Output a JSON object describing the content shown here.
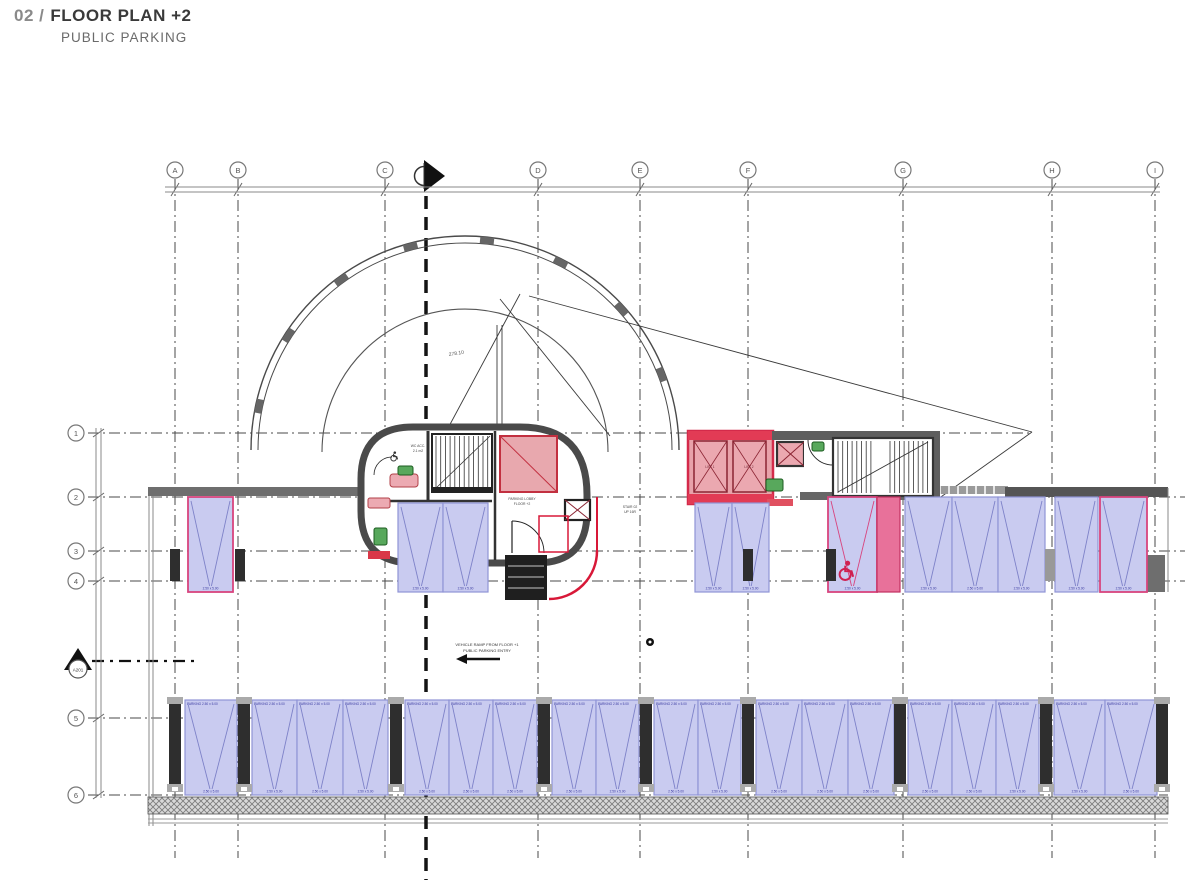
{
  "title": {
    "number": "02 /",
    "name": "FLOOR PLAN +2",
    "subtitle": "PUBLIC PARKING"
  },
  "colors": {
    "space_fill": "#c9cbf0",
    "space_border": "#9094d6",
    "space_line": "#7e82c8",
    "accent_pink_border": "#d8447e",
    "stripe_fill": "#e8719a",
    "stripe_border": "#c23060",
    "elevator_fill": "#e8a2aa",
    "elevator_frame": "#d42a4a",
    "elevator_inner": "#8b2433",
    "red_line": "#d81838",
    "wall_gray": "#6e6e6e",
    "wall_dark": "#3a3a3a",
    "grid_line": "#4a4a4a",
    "green_fixture": "#58a85c",
    "label_blue": "#3a3aa0"
  },
  "grid": {
    "columns": [
      {
        "label": "A",
        "x": 175
      },
      {
        "label": "B",
        "x": 238
      },
      {
        "label": "C",
        "x": 385
      },
      {
        "label": "D",
        "x": 538
      },
      {
        "label": "E",
        "x": 640
      },
      {
        "label": "F",
        "x": 748
      },
      {
        "label": "G",
        "x": 903
      },
      {
        "label": "H",
        "x": 1052
      },
      {
        "label": "I",
        "x": 1155
      }
    ],
    "rows": [
      {
        "label": "1",
        "y": 433,
        "x2": 1032
      },
      {
        "label": "2",
        "y": 497,
        "x2": 1185
      },
      {
        "label": "3",
        "y": 551,
        "x2": 1185
      },
      {
        "label": "4",
        "y": 581,
        "x2": 1185
      },
      {
        "label": "5",
        "y": 718,
        "x2": 1168
      },
      {
        "label": "6",
        "y": 795,
        "x2": 1168
      }
    ],
    "section_row_y": 661,
    "section_tag": "A201"
  },
  "arc": {
    "ticks_deg": [
      168,
      147,
      126,
      105,
      84,
      63,
      42,
      21
    ],
    "dim_label": "278.10"
  },
  "parking": {
    "space_label": "2.50 x 5.00",
    "space_label_top": "PARKING",
    "upper_row": [
      {
        "x": 188,
        "w": 45,
        "y": 497,
        "h": 95,
        "variant": "pink"
      },
      {
        "x": 398,
        "w": 45,
        "y": 503,
        "h": 89,
        "variant": "std"
      },
      {
        "x": 443,
        "w": 45,
        "y": 503,
        "h": 89,
        "variant": "std"
      },
      {
        "x": 695,
        "w": 37,
        "y": 503,
        "h": 89,
        "variant": "std"
      },
      {
        "x": 732,
        "w": 37,
        "y": 503,
        "h": 89,
        "variant": "std"
      },
      {
        "x": 828,
        "w": 49,
        "y": 497,
        "h": 95,
        "variant": "handicap"
      },
      {
        "x": 877,
        "w": 23,
        "y": 497,
        "h": 95,
        "variant": "stripe"
      },
      {
        "x": 905,
        "w": 47,
        "y": 497,
        "h": 95,
        "variant": "std"
      },
      {
        "x": 952,
        "w": 46,
        "y": 497,
        "h": 95,
        "variant": "std"
      },
      {
        "x": 998,
        "w": 47,
        "y": 497,
        "h": 95,
        "variant": "std"
      },
      {
        "x": 1055,
        "w": 43,
        "y": 497,
        "h": 95,
        "variant": "std"
      },
      {
        "x": 1100,
        "w": 47,
        "y": 497,
        "h": 95,
        "variant": "pink"
      }
    ],
    "lower_row": [
      {
        "x": 185,
        "w": 52
      },
      {
        "x": 252,
        "w": 45
      },
      {
        "x": 297,
        "w": 46
      },
      {
        "x": 343,
        "w": 45
      },
      {
        "x": 405,
        "w": 44
      },
      {
        "x": 449,
        "w": 44
      },
      {
        "x": 493,
        "w": 44
      },
      {
        "x": 552,
        "w": 44
      },
      {
        "x": 596,
        "w": 43
      },
      {
        "x": 654,
        "w": 44
      },
      {
        "x": 698,
        "w": 43
      },
      {
        "x": 756,
        "w": 46
      },
      {
        "x": 802,
        "w": 46
      },
      {
        "x": 848,
        "w": 46
      },
      {
        "x": 908,
        "w": 44
      },
      {
        "x": 952,
        "w": 44
      },
      {
        "x": 996,
        "w": 43
      },
      {
        "x": 1054,
        "w": 51
      },
      {
        "x": 1105,
        "w": 52
      }
    ],
    "pillars_mid": [
      170,
      235,
      743,
      826,
      1045
    ],
    "pillars_lower": [
      169,
      238,
      390,
      538,
      640,
      742,
      894,
      1040,
      1156
    ]
  },
  "annotations": {
    "ramp_note_1": "VEHICLE RAMP FROM FLOOR +1",
    "ramp_note_2": "PUBLIC PARKING ENTRY",
    "stair_note_1": "STAIR 02",
    "stair_note_2": "UP 16R",
    "lobby_note_1": "PARKING LOBBY",
    "lobby_note_2": "FLOOR +2",
    "wc_note_1": "WC ACC.",
    "wc_note_2": "2.1 m2",
    "lift1": "LIFT 1",
    "lift2": "LIFT 2"
  }
}
